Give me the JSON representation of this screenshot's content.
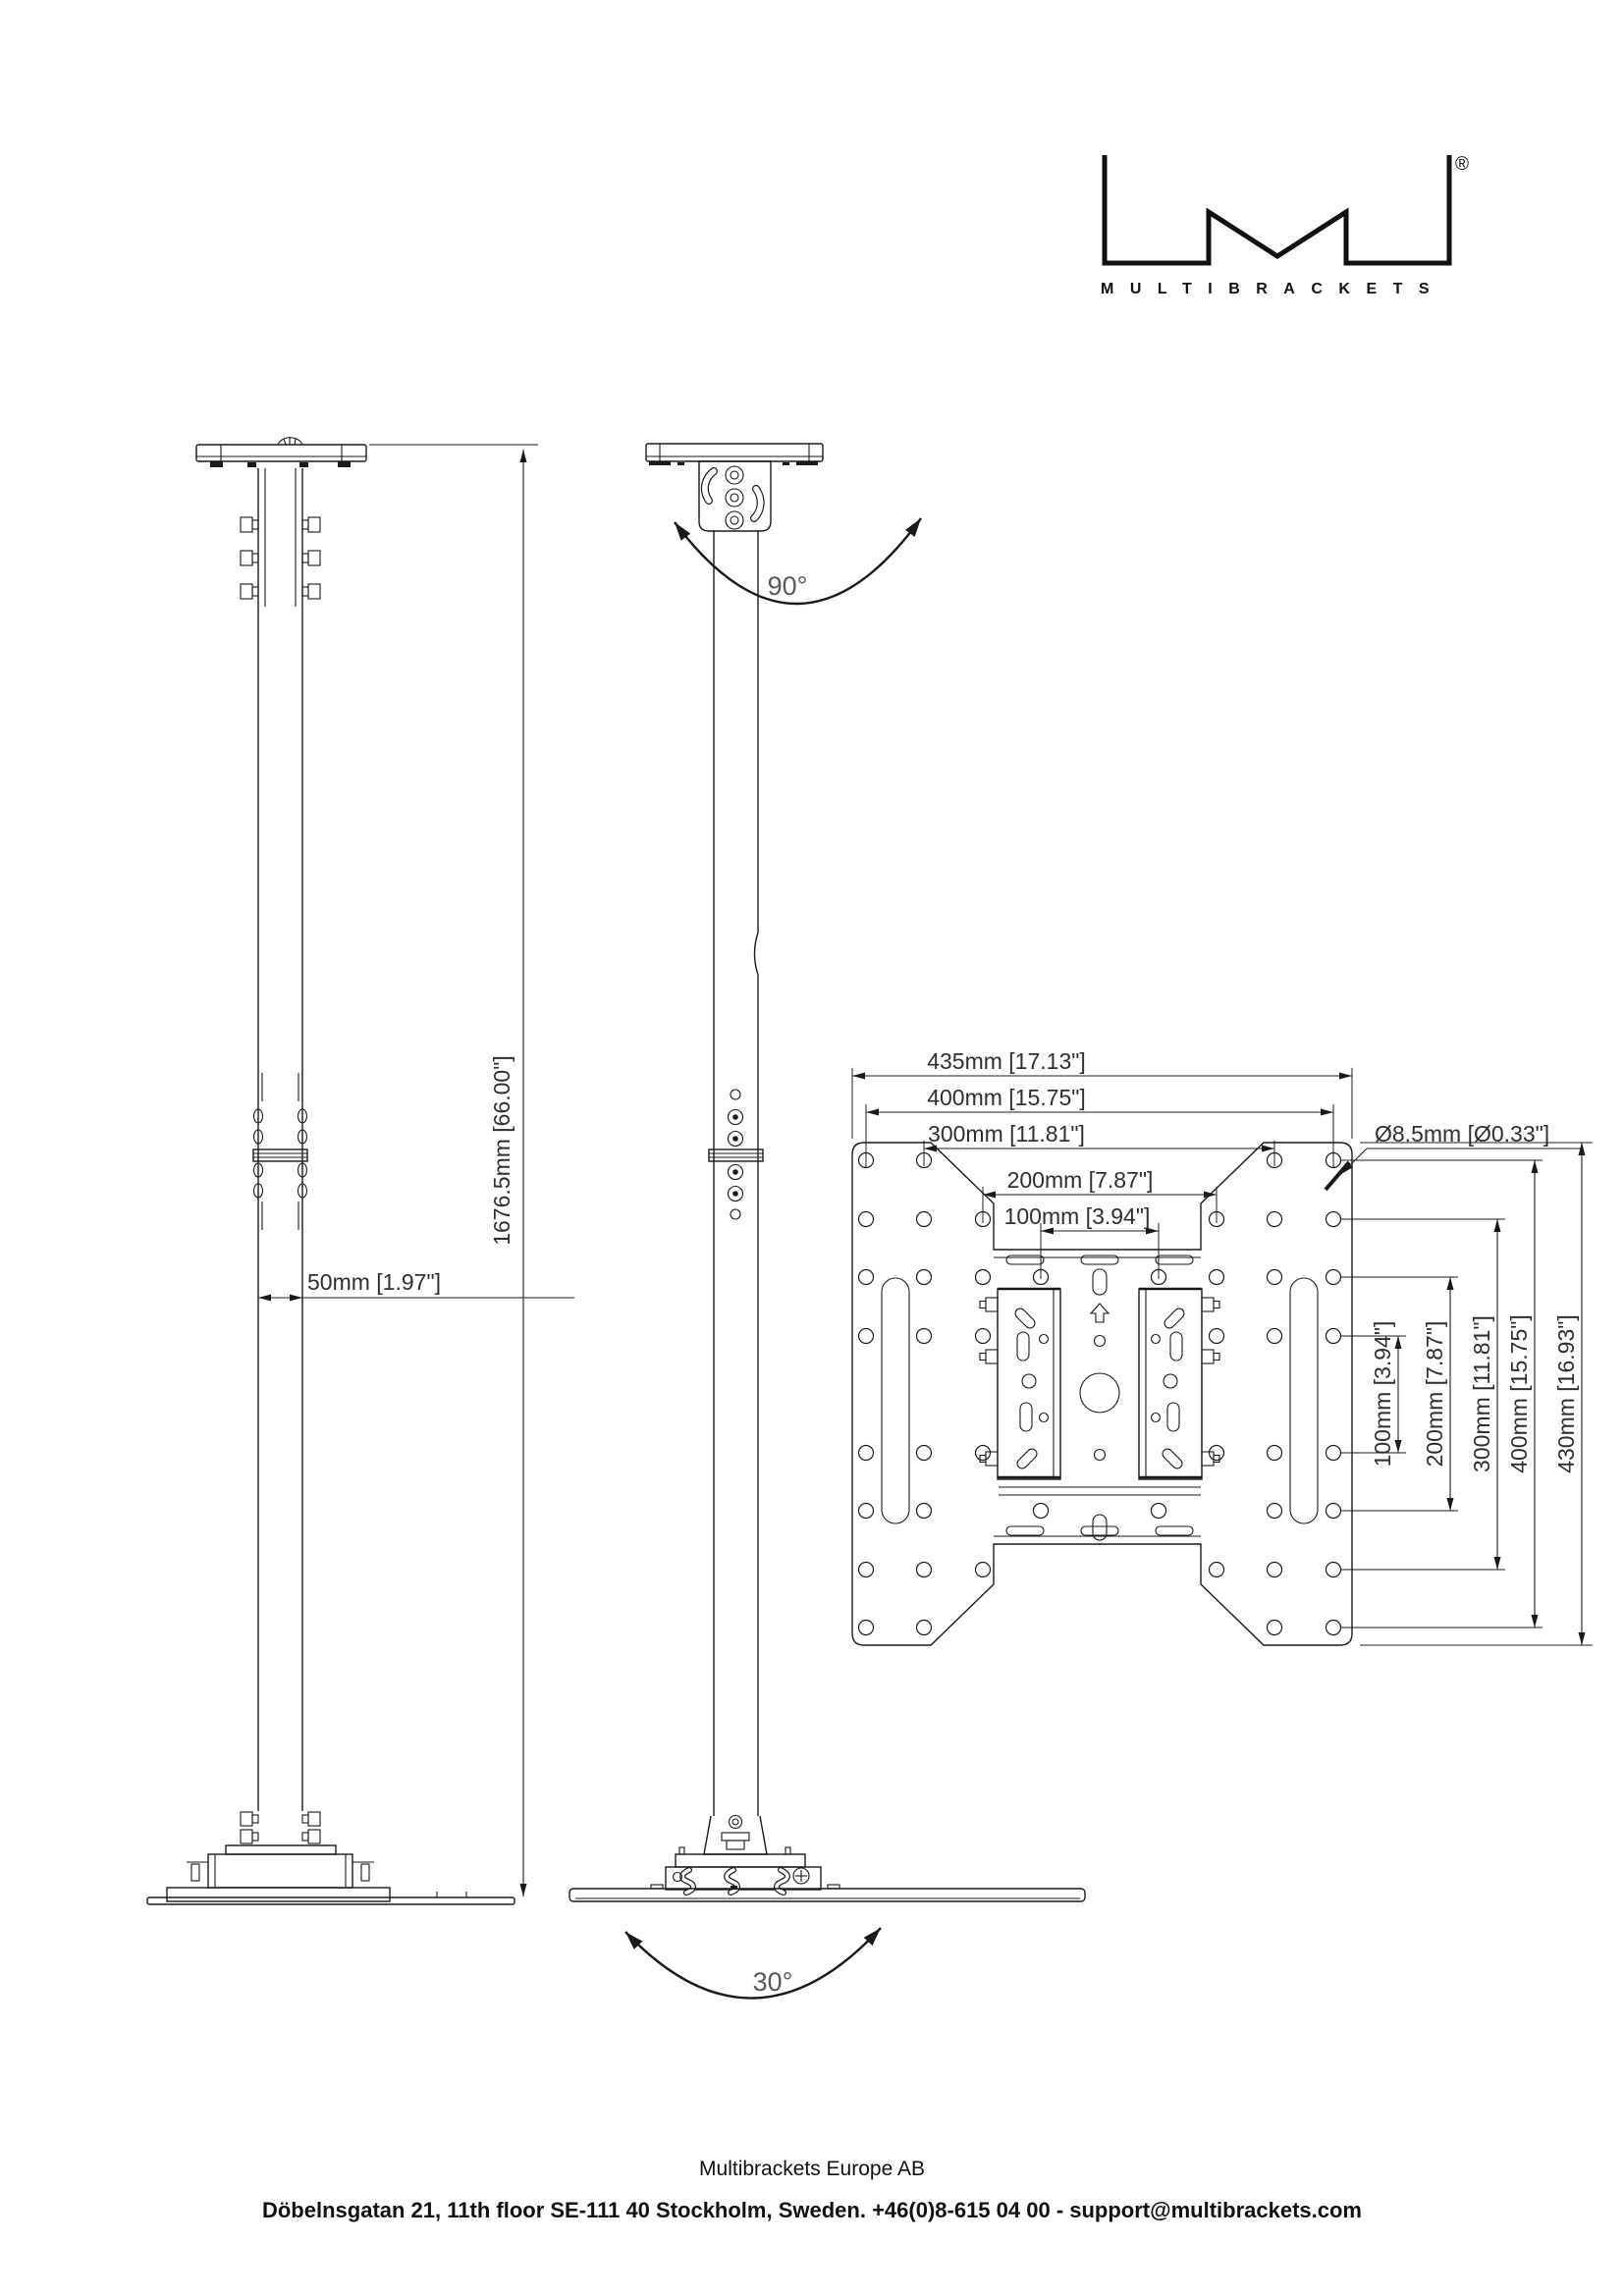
{
  "logo": {
    "brand": "MULTIBRACKETS",
    "registered_mark": "®"
  },
  "front_view": {
    "height_dim": "1676.5mm [66.00\"]",
    "pole_width_dim": "50mm [1.97\"]"
  },
  "side_view": {
    "top_tilt_angle": "90°",
    "bottom_swivel_angle": "30°"
  },
  "plate_view": {
    "horizontal_dims": [
      "435mm [17.13\"]",
      "400mm [15.75\"]",
      "300mm [11.81\"]",
      "200mm [7.87\"]",
      "100mm [3.94\"]"
    ],
    "vertical_dims": [
      "100mm [3.94\"]",
      "200mm [7.87\"]",
      "300mm [11.81\"]",
      "400mm [15.75\"]",
      "430mm [16.93\"]"
    ],
    "hole_diameter_dim": "Ø8.5mm [Ø0.33\"]"
  },
  "footer": {
    "company": "Multibrackets Europe AB",
    "contact": "Döbelnsgatan 21, 11th floor SE-111 40 Stockholm, Sweden. +46(0)8-615 04 00 - support@multibrackets.com"
  },
  "colors": {
    "line": "#1a1a1a",
    "dimension_text": "#2f2f2f",
    "angle_text": "#5a5a5a"
  }
}
